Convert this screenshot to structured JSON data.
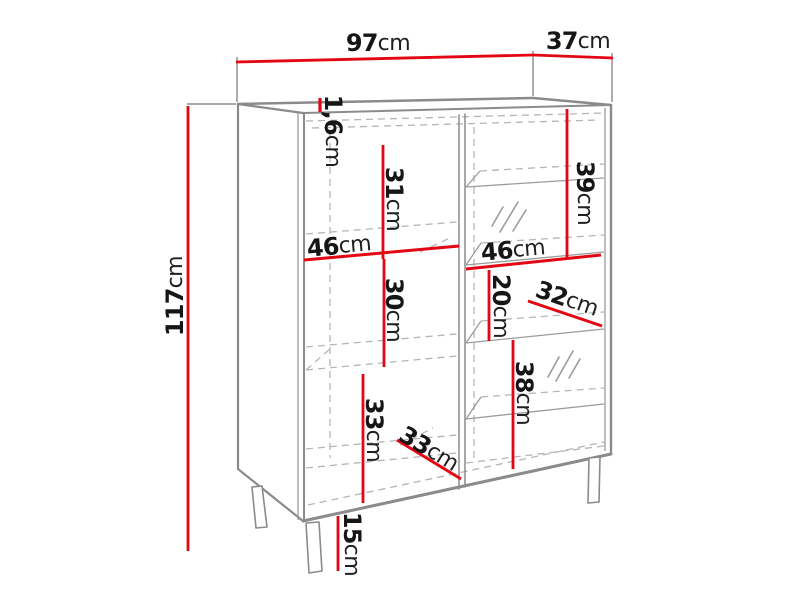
{
  "page": {
    "background": "#ffffff"
  },
  "diagram": {
    "kind": "furniture-dimension-drawing",
    "subject": "display cabinet with open shelves, glass panes and legs",
    "unit": "cm",
    "colors": {
      "dimension_line": "#e30613",
      "outline": "#8b8b8b",
      "hidden_line": "#b5b5b5",
      "label_text": "#161616",
      "background": "#ffffff"
    },
    "dims": {
      "width": {
        "value": "97",
        "unit": "cm"
      },
      "depth": {
        "value": "37",
        "unit": "cm"
      },
      "height": {
        "value": "117",
        "unit": "cm"
      },
      "top_panel_thickness": {
        "value": "1,6",
        "unit": "cm"
      },
      "left_upper_compartment_height": {
        "value": "31",
        "unit": "cm"
      },
      "left_shelf_width": {
        "value": "46",
        "unit": "cm"
      },
      "left_middle_compartment_height": {
        "value": "30",
        "unit": "cm"
      },
      "left_lower_compartment_height": {
        "value": "33",
        "unit": "cm"
      },
      "left_shelf_depth": {
        "value": "33",
        "unit": "cm"
      },
      "leg_height": {
        "value": "15",
        "unit": "cm"
      },
      "right_upper_compartment_height": {
        "value": "39",
        "unit": "cm"
      },
      "right_shelf_width": {
        "value": "46",
        "unit": "cm"
      },
      "right_middle_compartment_height": {
        "value": "20",
        "unit": "cm"
      },
      "right_shelf_depth": {
        "value": "32",
        "unit": "cm"
      },
      "right_lower_compartment_height": {
        "value": "38",
        "unit": "cm"
      }
    }
  }
}
